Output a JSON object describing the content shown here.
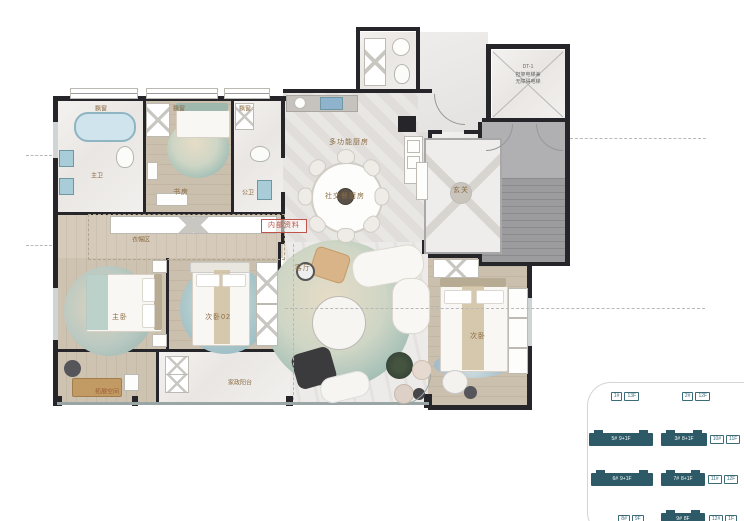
{
  "stamp": "内部资料",
  "rooms": {
    "bay_window": "飘窗",
    "master_bath": "主卫",
    "study": "书房",
    "public_bath": "公卫",
    "kitchen": "多功能厨房",
    "dining": "社交餐厨房",
    "foyer": "玄关",
    "living": "客厅",
    "cloakroom": "衣帽区",
    "master_bedroom": "主卧",
    "bedroom2": "次卧02",
    "bedroom3": "次卧",
    "service_balcony": "家政阳台",
    "expansion": "拓展空间"
  },
  "elevator": {
    "line1": "DT-1",
    "line2": "担架电梯兼",
    "line3": "无障碍电梯"
  },
  "site_plan": {
    "rows": [
      {
        "top": 12,
        "buildings": [
          {
            "left": 8,
            "width": 64,
            "filled": false,
            "labels": [
              "1#",
              "13F"
            ]
          },
          {
            "left": 82,
            "width": 58,
            "filled": false,
            "labels": [
              "2#",
              "12F"
            ]
          }
        ]
      },
      {
        "top": 55,
        "buildings": [
          {
            "left": 4,
            "width": 64,
            "filled": true,
            "labels": [
              "5#",
              "9+1F"
            ]
          },
          {
            "left": 76,
            "width": 46,
            "filled": true,
            "labels": [
              "3#",
              "8+1F"
            ]
          },
          {
            "left": 126,
            "width": 28,
            "filled": false,
            "labels": [
              "10#",
              "11F"
            ]
          }
        ]
      },
      {
        "top": 95,
        "buildings": [
          {
            "left": 6,
            "width": 62,
            "filled": true,
            "labels": [
              "6#",
              "9+1F"
            ]
          },
          {
            "left": 76,
            "width": 44,
            "filled": true,
            "labels": [
              "7#",
              "8+1F"
            ]
          },
          {
            "left": 124,
            "width": 28,
            "filled": false,
            "labels": [
              "11#",
              "12F"
            ]
          }
        ]
      },
      {
        "top": 135,
        "buildings": [
          {
            "left": 22,
            "width": 48,
            "filled": false,
            "labels": [
              "8#",
              "9F"
            ]
          },
          {
            "left": 76,
            "width": 44,
            "filled": true,
            "labels": [
              "9#",
              "8F"
            ]
          },
          {
            "left": 124,
            "width": 28,
            "filled": false,
            "labels": [
              "12#",
              "1F"
            ]
          }
        ]
      }
    ]
  },
  "colors": {
    "accent_teal": "#2d5a66",
    "label_brown": "#8a6a42",
    "stamp_red": "#c0544a",
    "wall_dark": "#26262a"
  }
}
